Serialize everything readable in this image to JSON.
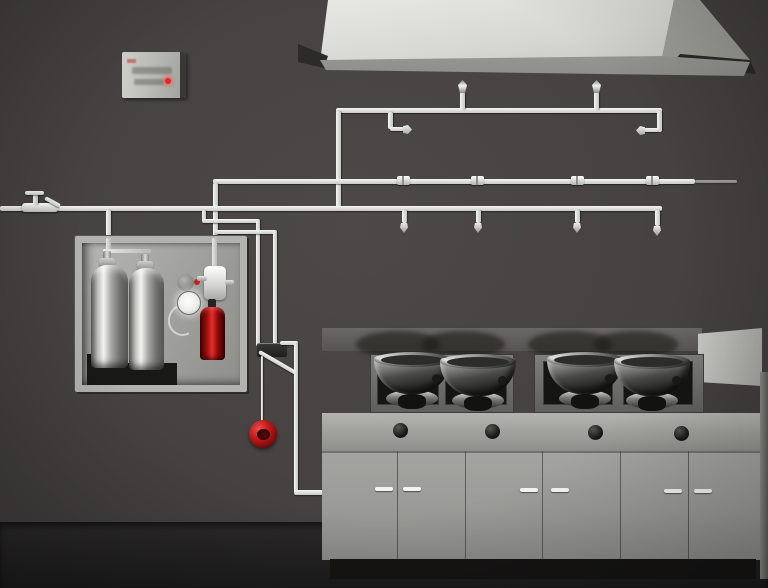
{
  "scene": {
    "title": "Commercial kitchen fire suppression system - 3D illustration",
    "components": {
      "control_panel": {
        "name": "alarm control panel",
        "indicator": "red status LED",
        "indicator_color": "#ee2222"
      },
      "exhaust_hood": {
        "name": "kitchen exhaust hood",
        "color": "#d6d6d2"
      },
      "piping": {
        "name": "suppression agent piping network",
        "color": "#e8e8e4",
        "duct_nozzles_up": 2,
        "plenum_nozzles_horizontal": 2,
        "appliance_nozzles_down": 4,
        "coupling_fittings": 4,
        "supply_valve": "manual lever valve on left supply line"
      },
      "agent_cabinet": {
        "name": "suppression agent cylinder cabinet",
        "silver_cylinders": 2,
        "red_cartridge_cylinders": 1,
        "pressure_gauge": 1,
        "cartridge_color": "#c01212",
        "cylinder_finish": "polished stainless"
      },
      "alarm_bell": {
        "name": "red alarm bell on drop pipe",
        "color": "#c01818"
      },
      "gas_line": {
        "name": "mechanical gas shutoff valve and downpipe to range base"
      },
      "cooking_range": {
        "name": "four-burner commercial wok range",
        "woks": 4,
        "burner_trays": 2,
        "control_knobs": 4,
        "cabinet_doors": 6,
        "door_handles": 6,
        "right_side_splash_panel": true
      }
    },
    "palette": {
      "wall": "#474443",
      "floor": "#1c1b1b",
      "pipe": "#e8e8e4",
      "hood": "#d6d6d2",
      "stove_body": "#9a9a97",
      "cooktop": "#1c1c1a",
      "stainless": "#c0c0bc",
      "alarm_red": "#c01818"
    }
  }
}
